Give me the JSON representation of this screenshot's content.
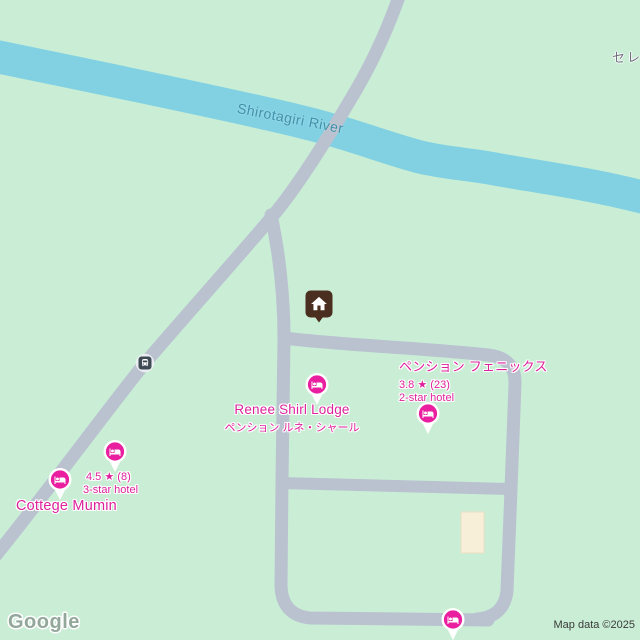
{
  "map": {
    "river_label": "Shirotagiri River",
    "locality_label": "セレ",
    "google_logo": "Google",
    "attribution": "Map data ©2025"
  },
  "colors": {
    "land": "#C9EED5",
    "water": "#82D1E3",
    "road": "#BAC2D0",
    "hotel_pin_fill": "#E91FA0",
    "hotel_label_text": "#DE219C",
    "water_label_text": "#3E90AA",
    "home_icon_brown": "#4A2E1F",
    "transit_icon_slate": "#3E4B55",
    "building_fill": "#F8EFD8"
  },
  "icons": {
    "hotel_pin": "bed-icon",
    "saved_place": "home-icon",
    "transit_stop": "bus-icon"
  },
  "places": {
    "renee_shirl_lodge": {
      "name": "Renee Shirl Lodge",
      "name_ja": "ペンション ルネ・シャール"
    },
    "pension_phoenix": {
      "name": "ペンション フェニックス",
      "rating": "3.8",
      "star": "★",
      "reviews": "(23)",
      "category": "2-star hotel"
    },
    "cottege_mumin": {
      "name": "Cottege Mumin",
      "rating": "4.5",
      "star": "★",
      "reviews": "(8)",
      "category": "3-star hotel"
    }
  }
}
